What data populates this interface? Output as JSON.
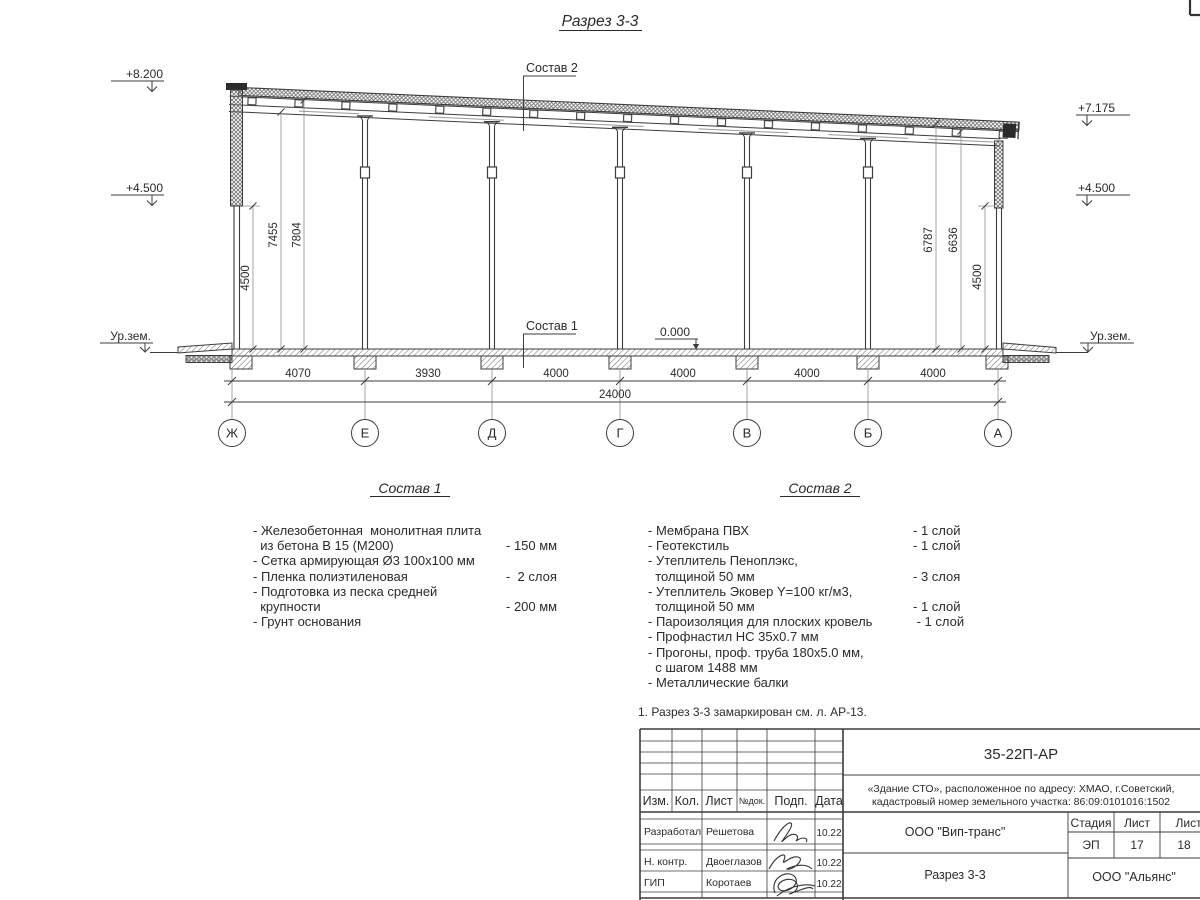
{
  "title": "Разрез 3-3",
  "drawing": {
    "elev_top_left": "+8.200",
    "elev_mid": "+4.500",
    "elev_top_right": "+7.175",
    "ground_label": "Ур.зем.",
    "zero_label": "0.000",
    "leader_sostav1": "Состав 1",
    "leader_sostav2": "Состав 2",
    "vdims_left": [
      "4500",
      "7455",
      "7804"
    ],
    "vdims_right": [
      "6787",
      "6636",
      "4500"
    ],
    "bay_dims": [
      "4070",
      "3930",
      "4000",
      "4000",
      "4000",
      "4000"
    ],
    "total_dim": "24000",
    "axes": [
      "Ж",
      "Е",
      "Д",
      "Г",
      "В",
      "Б",
      "А"
    ]
  },
  "sostav1": {
    "heading": "Состав 1",
    "lines": [
      {
        "t": "- Железобетонная  монолитная плита",
        "v": ""
      },
      {
        "t": "  из бетона В 15 (М200)",
        "v": "- 150 мм"
      },
      {
        "t": "- Сетка армирующая Ø3 100х100 мм",
        "v": ""
      },
      {
        "t": "- Пленка полиэтиленовая",
        "v": "-  2 слоя"
      },
      {
        "t": "- Подготовка из песка средней",
        "v": ""
      },
      {
        "t": "  крупности",
        "v": "- 200 мм"
      },
      {
        "t": "- Грунт основания",
        "v": ""
      }
    ]
  },
  "sostav2": {
    "heading": "Состав 2",
    "lines": [
      {
        "t": "- Мембрана ПВХ",
        "v": "- 1 слой"
      },
      {
        "t": "- Геотекстиль",
        "v": "- 1 слой"
      },
      {
        "t": "- Утеплитель Пеноплэкс,",
        "v": ""
      },
      {
        "t": "  толщиной 50 мм",
        "v": "- 3 слоя"
      },
      {
        "t": "- Утеплитель Эковер Y=100 кг/м3,",
        "v": ""
      },
      {
        "t": "  толщиной 50 мм",
        "v": "- 1 слой"
      },
      {
        "t": "- Пароизоляция для плоских кровель",
        "v": " - 1 слой"
      },
      {
        "t": "- Профнастил НС 35х0.7 мм",
        "v": ""
      },
      {
        "t": "- Прогоны, проф. труба 180х5.0 мм,",
        "v": ""
      },
      {
        "t": "  с шагом 1488 мм",
        "v": ""
      },
      {
        "t": "- Металлические балки",
        "v": ""
      }
    ]
  },
  "note": "1. Разрез 3-3 замаркирован см. л. АР-13.",
  "titleblock": {
    "doc_number": "35-22П-АР",
    "object_line1": "«Здание СТО», расположенное по адресу: ХМАО, г.Советский,",
    "object_line2": "кадастровый номер земельного участка: 86:09:0101016:1502",
    "col_izm": "Изм.",
    "col_kol": "Кол.",
    "col_list": "Лист",
    "col_ndok": "№док.",
    "col_podp": "Подп.",
    "col_data": "Дата",
    "rows": [
      {
        "role": "Разработал",
        "name": "Решетова",
        "date": "10.22"
      },
      {
        "role": "Н. контр.",
        "name": "Двоеглазов",
        "date": "10.22"
      },
      {
        "role": "ГИП",
        "name": "Коротаев",
        "date": "10.22"
      }
    ],
    "org_design": "ООО \"Вип-транс\"",
    "sheet_name": "Разрез 3-3",
    "stage_label": "Стадия",
    "sheet_label": "Лист",
    "sheets_label": "Листов",
    "stage": "ЭП",
    "sheet_no": "17",
    "sheets_total": "18",
    "org_customer": "ООО \"Альянс\""
  }
}
